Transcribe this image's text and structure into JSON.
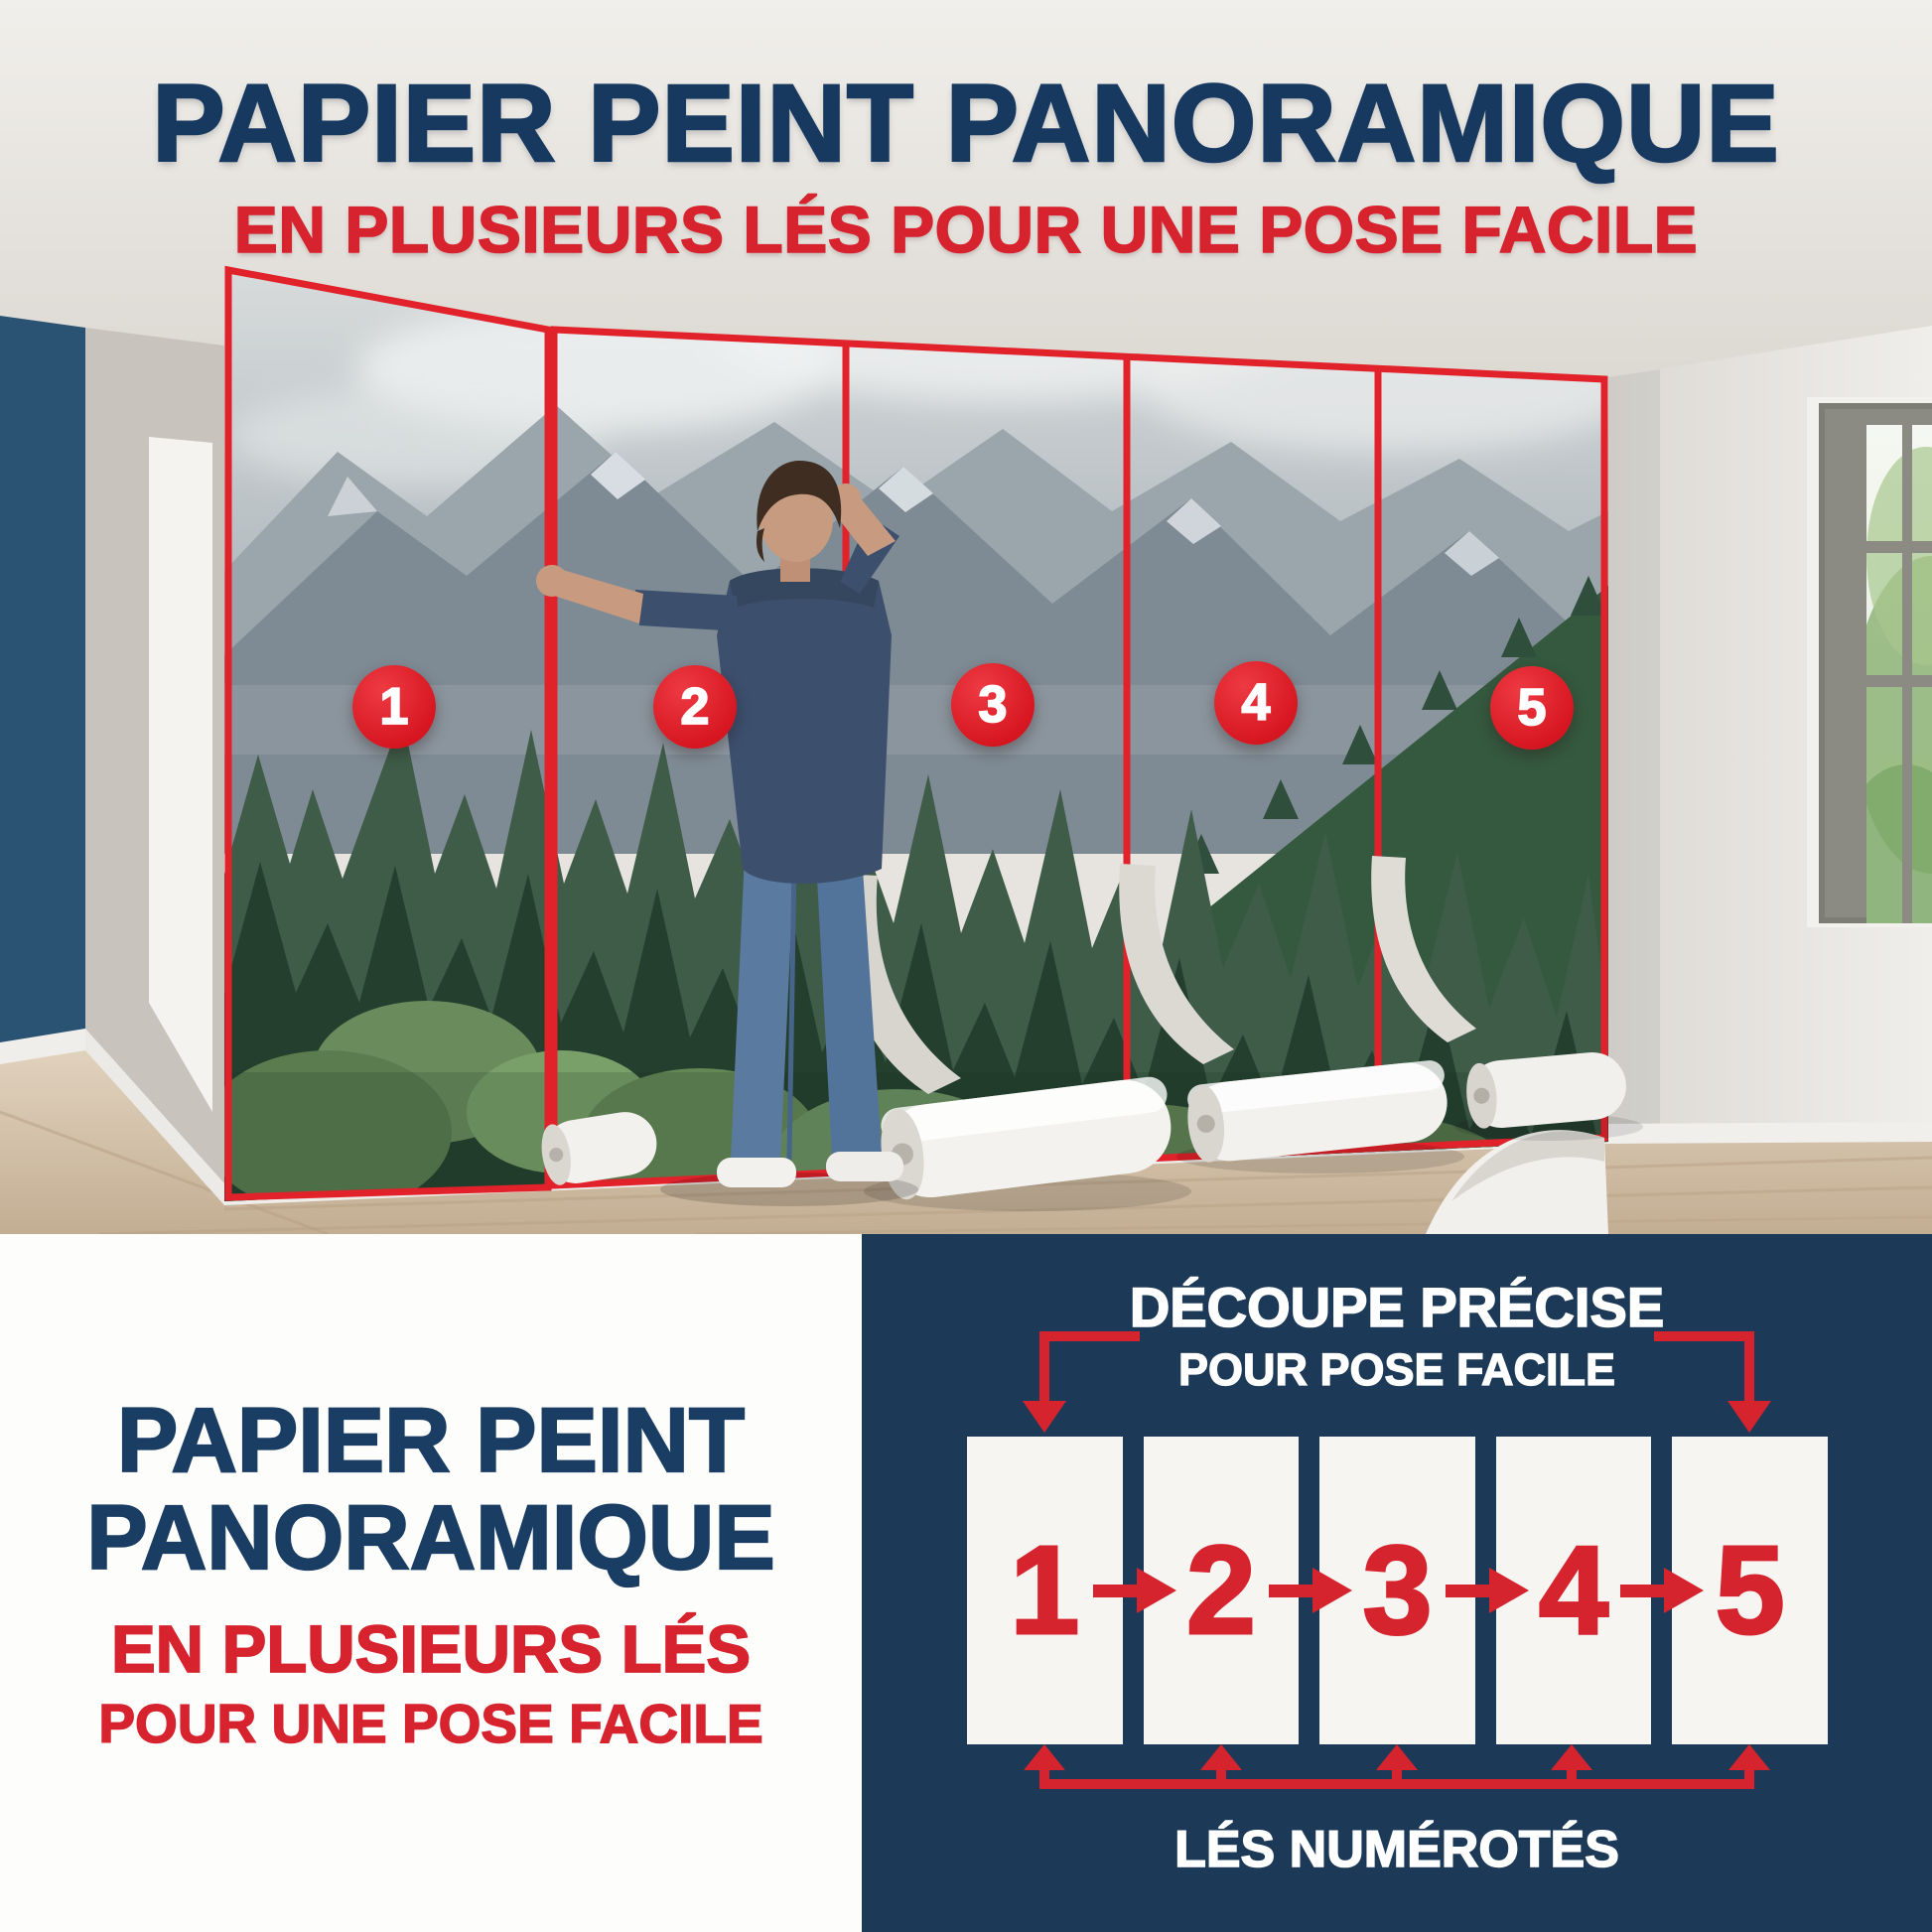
{
  "hero": {
    "title": "PAPIER PEINT PANORAMIQUE",
    "subtitle": "EN PLUSIEURS LÉS POUR UNE POSE FACILE",
    "badges": [
      "1",
      "2",
      "3",
      "4",
      "5"
    ]
  },
  "bottom_left": {
    "title_line1": "PAPIER PEINT",
    "title_line2": "PANORAMIQUE",
    "accent_line1": "EN PLUSIEURS LÉS",
    "accent_line2": "POUR UNE POSE FACILE"
  },
  "diagram": {
    "heading_line1": "DÉCOUPE PRÉCISE",
    "heading_line2": "POUR POSE FACILE",
    "panels": [
      "1",
      "2",
      "3",
      "4",
      "5"
    ],
    "caption": "LÉS NUMÉROTÉS"
  },
  "colors": {
    "navy_section": "#1c3a57",
    "title_navy": "#17395f",
    "red": "#d6232e",
    "badge_red": "#d5151f",
    "panel_white": "#f7f5f2"
  }
}
